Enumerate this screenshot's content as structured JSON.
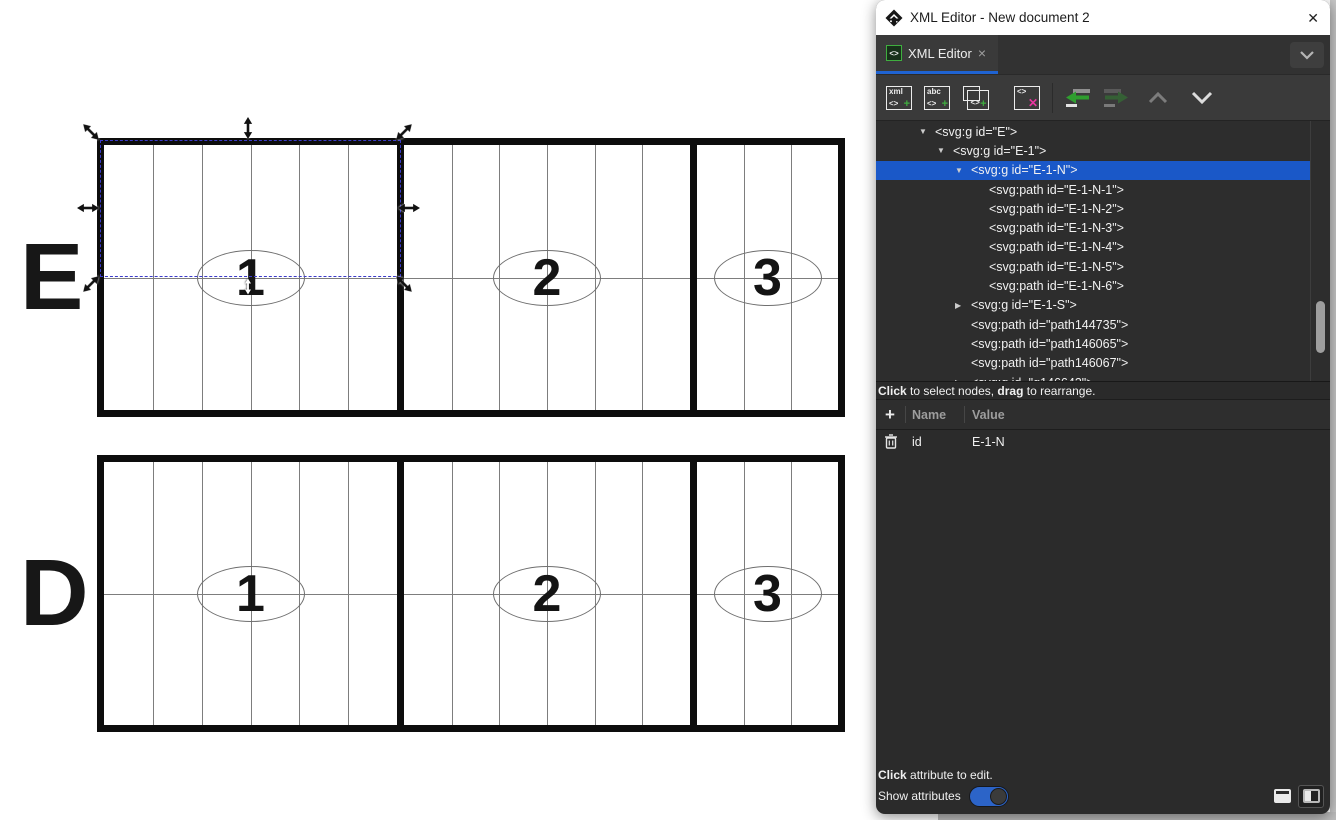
{
  "colors": {
    "accent_blue": "#1f63d2",
    "selection_blue": "#1a58c8",
    "add_green": "#3fae3f",
    "delete_pink": "#e8359f",
    "canvas_line_gray": "#7d7d7d"
  },
  "window": {
    "title": "XML Editor - New document 2",
    "close_glyph": "✕"
  },
  "tab": {
    "icon_text": "<>",
    "label": "XML Editor",
    "close_glyph": "×"
  },
  "toolbar": {
    "new_element_node": {
      "line1": "xml",
      "tag": "<>",
      "plus": "+"
    },
    "new_text_node": {
      "line1": "abc",
      "tag": "<>",
      "plus": "+"
    },
    "duplicate_node": {
      "tag": "<>",
      "plus": "+"
    },
    "delete_node": {
      "tag": "<>",
      "x": "✕"
    }
  },
  "tree": {
    "rows": [
      {
        "indent": 1,
        "arrow": "open",
        "text": "<svg:g id=\"E\">",
        "selected": false
      },
      {
        "indent": 2,
        "arrow": "open",
        "text": "<svg:g id=\"E-1\">",
        "selected": false
      },
      {
        "indent": 3,
        "arrow": "open",
        "text": "<svg:g id=\"E-1-N\">",
        "selected": true
      },
      {
        "indent": 4,
        "arrow": "none",
        "text": "<svg:path id=\"E-1-N-1\">",
        "selected": false
      },
      {
        "indent": 4,
        "arrow": "none",
        "text": "<svg:path id=\"E-1-N-2\">",
        "selected": false
      },
      {
        "indent": 4,
        "arrow": "none",
        "text": "<svg:path id=\"E-1-N-3\">",
        "selected": false
      },
      {
        "indent": 4,
        "arrow": "none",
        "text": "<svg:path id=\"E-1-N-4\">",
        "selected": false
      },
      {
        "indent": 4,
        "arrow": "none",
        "text": "<svg:path id=\"E-1-N-5\">",
        "selected": false
      },
      {
        "indent": 4,
        "arrow": "none",
        "text": "<svg:path id=\"E-1-N-6\">",
        "selected": false
      },
      {
        "indent": 3,
        "arrow": "closed",
        "text": "<svg:g id=\"E-1-S\">",
        "selected": false
      },
      {
        "indent": 3,
        "arrow": "none",
        "text": "<svg:path id=\"path144735\">",
        "selected": false
      },
      {
        "indent": 3,
        "arrow": "none",
        "text": "<svg:path id=\"path146065\">",
        "selected": false
      },
      {
        "indent": 3,
        "arrow": "none",
        "text": "<svg:path id=\"path146067\">",
        "selected": false
      },
      {
        "indent": 3,
        "arrow": "closed",
        "text": "<svg:g id=\"g146643\">",
        "selected": false
      }
    ]
  },
  "tree_hint": {
    "bold1": "Click",
    "text1": " to select nodes, ",
    "bold2": "drag",
    "text2": " to rearrange."
  },
  "attributes": {
    "add_glyph": "+",
    "name_header": "Name",
    "value_header": "Value",
    "rows": [
      {
        "name": "id",
        "value": "E-1-N"
      }
    ]
  },
  "footer": {
    "hint_bold": "Click",
    "hint_rest": " attribute to edit.",
    "toggle_label": "Show attributes",
    "toggle_on": true
  },
  "canvas": {
    "figures": [
      {
        "label": "E",
        "y": 138,
        "h": 279,
        "sections": [
          {
            "cols": 6,
            "num": "1"
          },
          {
            "cols": 6,
            "num": "2"
          },
          {
            "cols": 3,
            "num": "3"
          }
        ]
      },
      {
        "label": "D",
        "y": 455,
        "h": 277,
        "sections": [
          {
            "cols": 6,
            "num": "1"
          },
          {
            "cols": 6,
            "num": "2"
          },
          {
            "cols": 3,
            "num": "3"
          }
        ]
      }
    ],
    "selection": {
      "node_id": "E-1-N",
      "handles": [
        {
          "id": "nw",
          "kind": "diagonal-nwse"
        },
        {
          "id": "n",
          "kind": "vertical"
        },
        {
          "id": "ne",
          "kind": "diagonal-nesw"
        },
        {
          "id": "w",
          "kind": "horizontal"
        },
        {
          "id": "e",
          "kind": "horizontal"
        },
        {
          "id": "sw",
          "kind": "diagonal-nesw"
        },
        {
          "id": "se",
          "kind": "diagonal-nwse"
        },
        {
          "id": "s",
          "kind": "vertical",
          "inverted": true
        }
      ]
    }
  }
}
